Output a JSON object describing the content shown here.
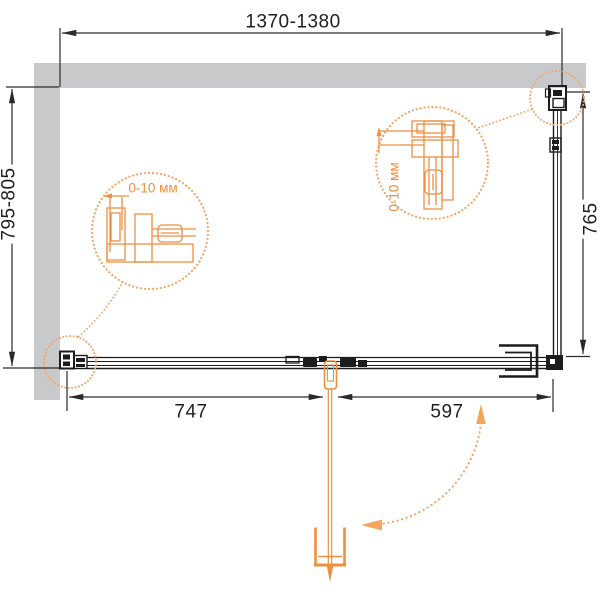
{
  "drawing": {
    "dimensions": {
      "width_top": "1370-1380",
      "depth_left": "795-805",
      "depth_right": "765",
      "span_bottom_left": "747",
      "span_bottom_right": "597"
    },
    "callouts": {
      "left_gap": "0-10 мм",
      "right_gap": "0-10 мм"
    },
    "colors": {
      "wall_gray": "#C8C9CB",
      "line_black": "#2A2A2A",
      "accent_orange": "#EE8F3F",
      "dotted_orange": "#F2A669"
    }
  }
}
